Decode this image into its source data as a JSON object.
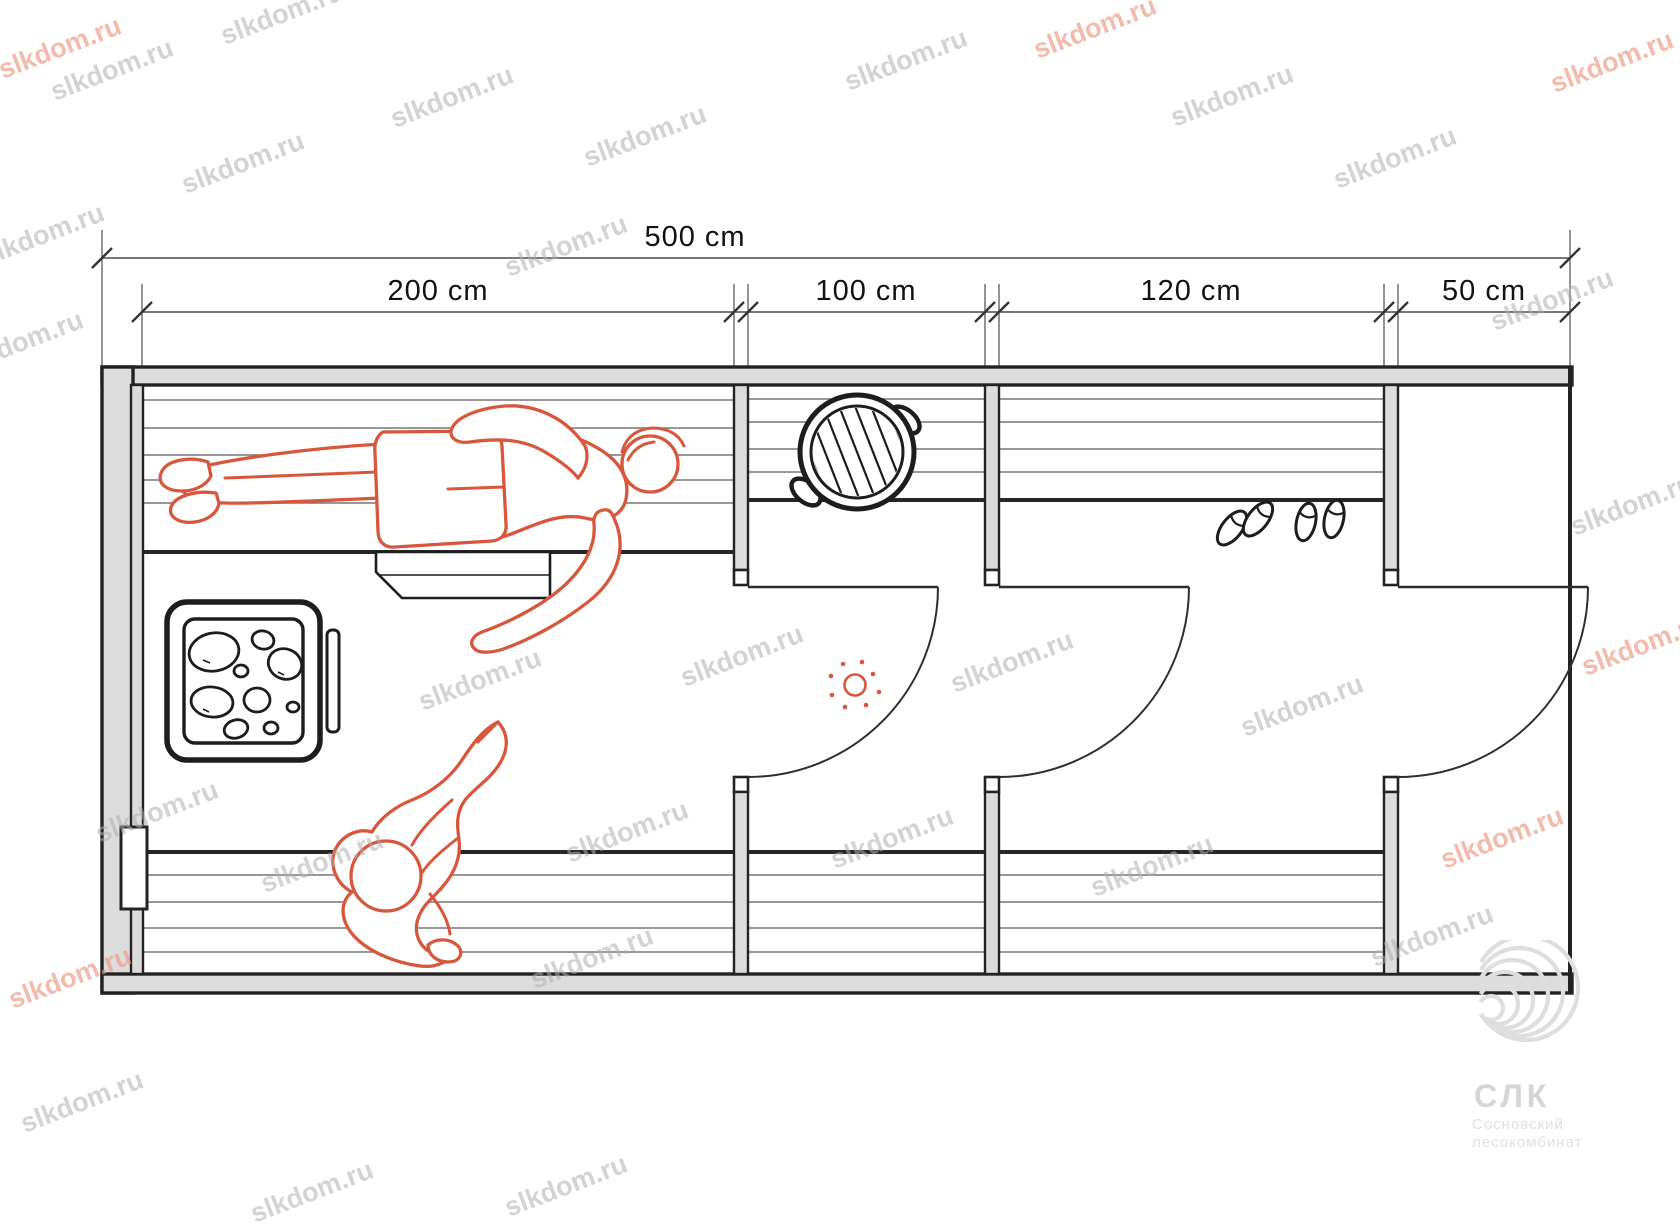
{
  "watermark": {
    "text": "slkdom.ru"
  },
  "dimensions": {
    "total": {
      "label": "500 cm"
    },
    "segments": [
      {
        "label": "200 cm"
      },
      {
        "label": "100 cm"
      },
      {
        "label": "120 cm"
      },
      {
        "label": "50 cm"
      }
    ]
  },
  "logo": {
    "abbr": "СЛК",
    "line1": "Сосновский",
    "line2": "лесокомбинат"
  },
  "watermarks": [
    {
      "x": 60,
      "y": 48,
      "v": "red"
    },
    {
      "x": 1095,
      "y": 28,
      "v": "red"
    },
    {
      "x": 1612,
      "y": 62,
      "v": "red"
    },
    {
      "x": 1643,
      "y": 645,
      "v": "red"
    },
    {
      "x": 70,
      "y": 978,
      "v": "red"
    },
    {
      "x": 1502,
      "y": 838,
      "v": "red"
    },
    {
      "x": 112,
      "y": 70,
      "v": "gray"
    },
    {
      "x": 282,
      "y": 14,
      "v": "gray"
    },
    {
      "x": 452,
      "y": 97,
      "v": "gray"
    },
    {
      "x": 243,
      "y": 163,
      "v": "gray"
    },
    {
      "x": 43,
      "y": 235,
      "v": "gray"
    },
    {
      "x": 645,
      "y": 136,
      "v": "gray"
    },
    {
      "x": 906,
      "y": 60,
      "v": "gray"
    },
    {
      "x": 566,
      "y": 246,
      "v": "gray"
    },
    {
      "x": 1232,
      "y": 96,
      "v": "gray"
    },
    {
      "x": 1395,
      "y": 158,
      "v": "gray"
    },
    {
      "x": 1552,
      "y": 300,
      "v": "gray"
    },
    {
      "x": 22,
      "y": 342,
      "v": "gray"
    },
    {
      "x": 742,
      "y": 656,
      "v": "gray"
    },
    {
      "x": 1012,
      "y": 662,
      "v": "gray"
    },
    {
      "x": 1302,
      "y": 706,
      "v": "gray"
    },
    {
      "x": 480,
      "y": 680,
      "v": "gray"
    },
    {
      "x": 627,
      "y": 832,
      "v": "gray"
    },
    {
      "x": 892,
      "y": 838,
      "v": "gray"
    },
    {
      "x": 1152,
      "y": 866,
      "v": "gray"
    },
    {
      "x": 1432,
      "y": 936,
      "v": "gray"
    },
    {
      "x": 322,
      "y": 862,
      "v": "gray"
    },
    {
      "x": 157,
      "y": 812,
      "v": "gray"
    },
    {
      "x": 592,
      "y": 958,
      "v": "gray"
    },
    {
      "x": 1632,
      "y": 505,
      "v": "gray"
    },
    {
      "x": 566,
      "y": 1186,
      "v": "gray"
    },
    {
      "x": 312,
      "y": 1192,
      "v": "gray"
    },
    {
      "x": 82,
      "y": 1102,
      "v": "gray"
    }
  ]
}
